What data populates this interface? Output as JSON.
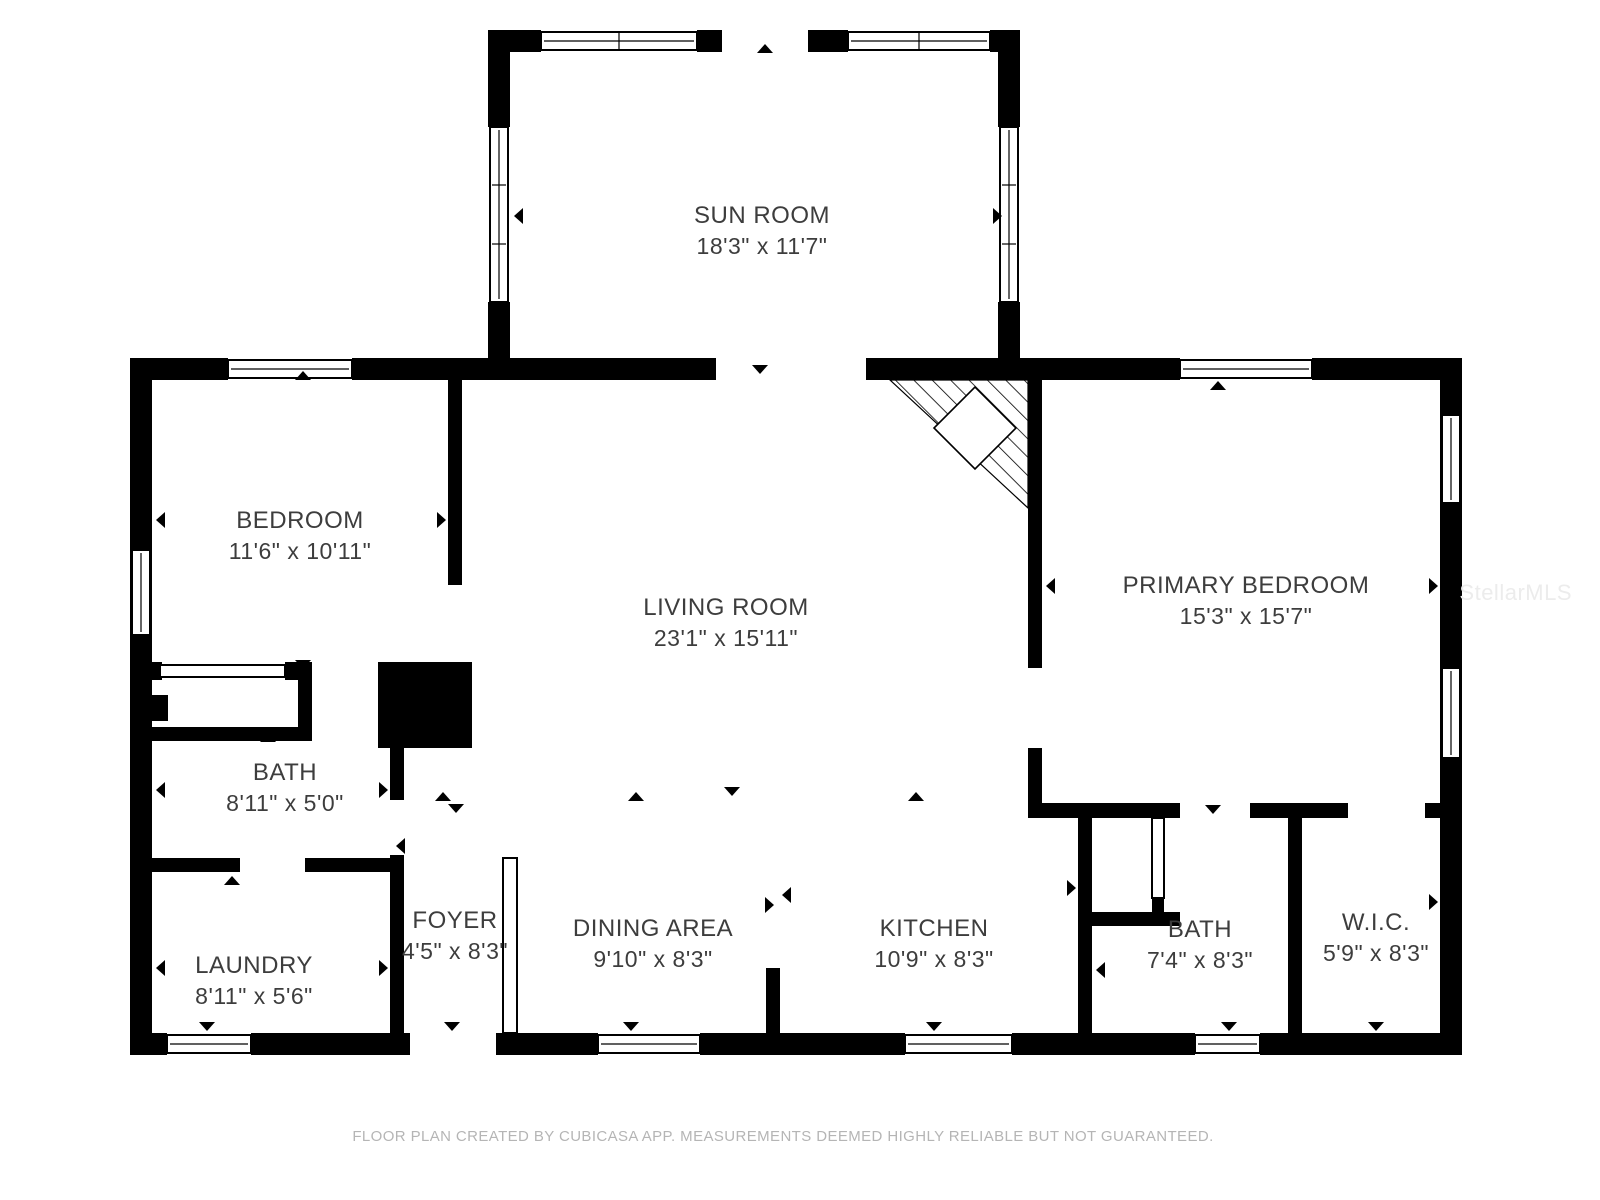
{
  "title": "Floor plan",
  "colors": {
    "wall": "#000000",
    "room_label_text": "#3d3d3d",
    "footer_text": "#b5b5b5",
    "watermark_text": "#ececec",
    "background": "#ffffff"
  },
  "rooms": {
    "sun_room": {
      "name": "SUN ROOM",
      "dims": "18'3\" x 11'7\""
    },
    "bedroom": {
      "name": "BEDROOM",
      "dims": "11'6\" x 10'11\""
    },
    "living_room": {
      "name": "LIVING ROOM",
      "dims": "23'1\" x 15'11\""
    },
    "primary_bedroom": {
      "name": "PRIMARY BEDROOM",
      "dims": "15'3\" x 15'7\""
    },
    "bath": {
      "name": "BATH",
      "dims": "8'11\" x 5'0\""
    },
    "laundry": {
      "name": "LAUNDRY",
      "dims": "8'11\" x 5'6\""
    },
    "foyer": {
      "name": "FOYER",
      "dims": "4'5\" x 8'3\""
    },
    "dining_area": {
      "name": "DINING AREA",
      "dims": "9'10\" x 8'3\""
    },
    "kitchen": {
      "name": "KITCHEN",
      "dims": "10'9\" x 8'3\""
    },
    "bath2": {
      "name": "BATH",
      "dims": "7'4\" x 8'3\""
    },
    "wic": {
      "name": "W.I.C.",
      "dims": "5'9\" x 8'3\""
    }
  },
  "footer": {
    "text": "FLOOR PLAN CREATED BY CUBICASA APP. MEASUREMENTS DEEMED HIGHLY RELIABLE BUT NOT GUARANTEED."
  },
  "watermark": {
    "text": "StellarMLS"
  }
}
